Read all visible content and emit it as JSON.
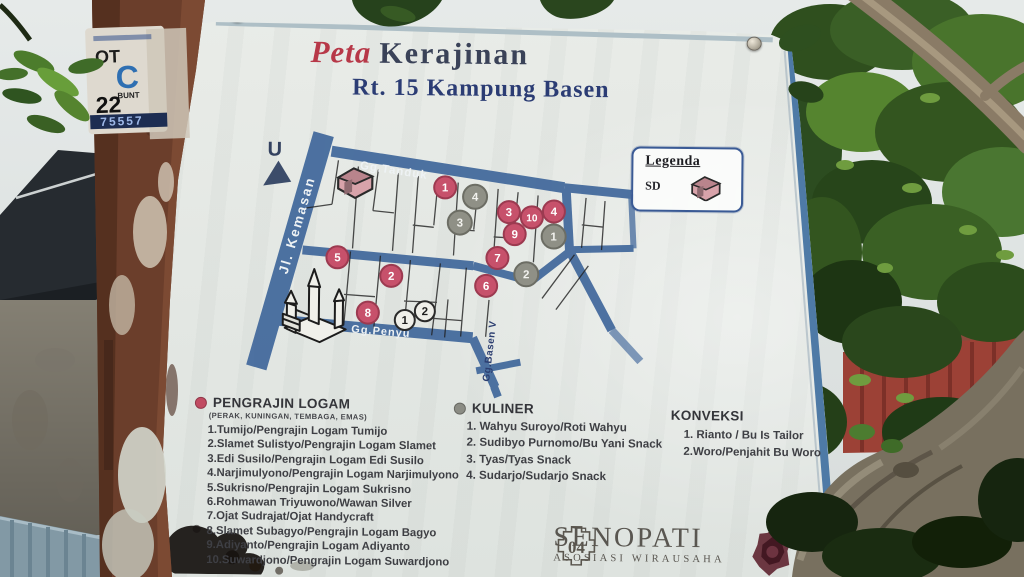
{
  "colors": {
    "title_red": "#b73848",
    "title_navy": "#3a4258",
    "subtitle_navy": "#2b3c74",
    "road_blue": "#40679b",
    "list_ink": "#3e3f44",
    "senopati_ink": "#595650"
  },
  "sign": {
    "title": {
      "word1": "Peta",
      "word2": "Kerajinan"
    },
    "subtitle": "Rt. 15 Kampung Basen",
    "north_label": "U",
    "legend": {
      "title": "Legenda",
      "item": "SD"
    },
    "map": {
      "roads": {
        "kemasan": "Jl. Kemasan",
        "tanduk": "Gg.Tanduk",
        "penyu": "Gg.Penyu",
        "basen": "Gg.Basen V"
      },
      "marker_styles": {
        "red": {
          "fill": "#c7516b",
          "stroke": "#9c3a50",
          "r": 11,
          "text": "#ffffff"
        },
        "gray": {
          "fill": "#8f9086",
          "stroke": "#6c6d64",
          "r": 12,
          "text": "#f2f2ee"
        },
        "white": {
          "fill": "#efefe9",
          "stroke": "#2a2a2a",
          "r": 10,
          "text": "#1c1c1c"
        }
      },
      "markers": {
        "red": [
          {
            "n": "1",
            "x": 444,
            "y": 188
          },
          {
            "n": "2",
            "x": 391,
            "y": 277
          },
          {
            "n": "3",
            "x": 508,
            "y": 212
          },
          {
            "n": "4",
            "x": 553,
            "y": 211
          },
          {
            "n": "5",
            "x": 337,
            "y": 259
          },
          {
            "n": "6",
            "x": 486,
            "y": 286
          },
          {
            "n": "7",
            "x": 497,
            "y": 258
          },
          {
            "n": "8",
            "x": 368,
            "y": 314
          },
          {
            "n": "9",
            "x": 514,
            "y": 234
          },
          {
            "n": "10",
            "x": 531,
            "y": 217
          }
        ],
        "gray": [
          {
            "n": "1",
            "x": 553,
            "y": 236
          },
          {
            "n": "2",
            "x": 526,
            "y": 274
          },
          {
            "n": "3",
            "x": 459,
            "y": 223
          },
          {
            "n": "4",
            "x": 474,
            "y": 197
          }
        ],
        "white": [
          {
            "n": "1",
            "x": 405,
            "y": 321
          },
          {
            "n": "2",
            "x": 425,
            "y": 312
          }
        ]
      }
    },
    "lists": [
      {
        "header": "PENGRAJIN LOGAM",
        "subheader": "(PERAK, KUNINGAN, TEMBAGA, EMAS)",
        "bullet_color": "#c14b62",
        "items": [
          "1.Tumijo/Pengrajin Logam Tumijo",
          "2.Slamet Sulistyo/Pengrajin Logam Slamet",
          "3.Edi Susilo/Pengrajin Logam Edi Susilo",
          "4.Narjimulyono/Pengrajin Logam Narjimulyono",
          "5.Sukrisno/Pengrajin Logam Sukrisno",
          "6.Rohmawan Triyuwono/Wawan Silver",
          "7.Ojat Sudrajat/Ojat Handycraft",
          "8.Slamet Subagyo/Pengrajin Logam Bagyo",
          "9.Adiyanto/Pengrajin Logam Adiyanto",
          "10.Suwardjono/Pengrajin Logam Suwardjono"
        ]
      },
      {
        "header": "KULINER",
        "bullet_color": "#8b8c84",
        "items": [
          "1. Wahyu Suroyo/Roti Wahyu",
          "2. Sudibyo Purnomo/Bu Yani Snack",
          "3. Tyas/Tyas Snack",
          "4. Sudarjo/Sudarjo Snack"
        ]
      },
      {
        "header": "KONVEKSI",
        "items": [
          "1. Rianto / Bu Is Tailor",
          "2.Woro/Penjahit Bu Woro"
        ]
      }
    ],
    "logo": {
      "number": "04",
      "name": "SENOPATI",
      "tagline": "ASOSIASI WIRAUSAHA"
    }
  },
  "sticker": {
    "top": "OT",
    "big_letter": "C",
    "mid": "BUNT",
    "number": "22",
    "serial": "75557"
  }
}
